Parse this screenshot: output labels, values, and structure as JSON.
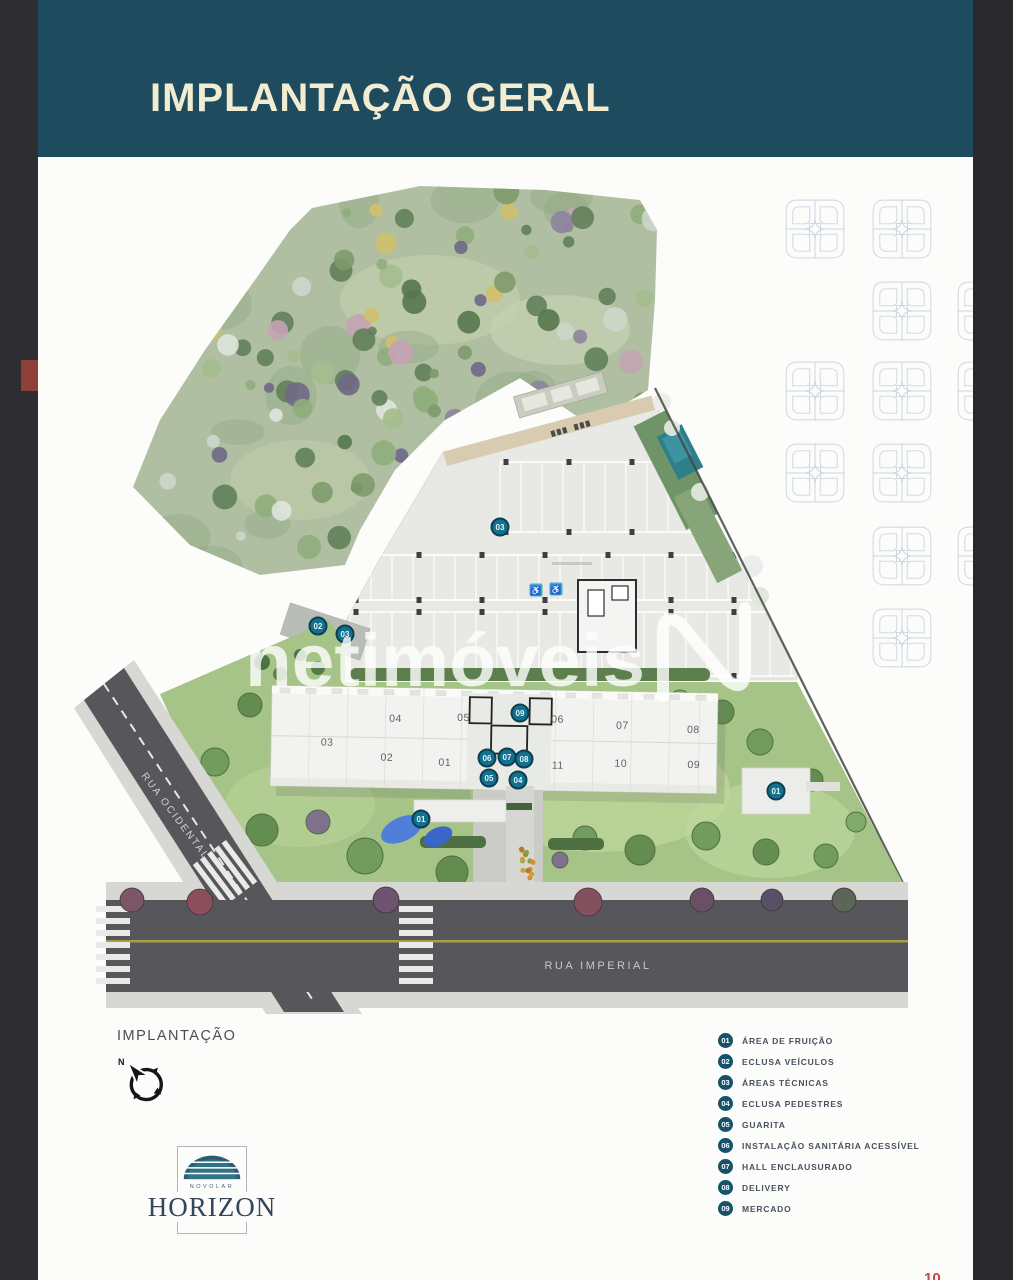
{
  "window": {
    "left_strip_color": "#2e2e32",
    "right_strip_color": "#29292d",
    "page_bg": "#fcfcfb"
  },
  "header": {
    "title": "IMPLANTAÇÃO GERAL",
    "bg_color": "#1e4c5e",
    "text_color": "#f2ecd2"
  },
  "watermark": {
    "text": "netimóveis",
    "logo": "netimoveis-n-outline"
  },
  "site_plan": {
    "streets": [
      {
        "name": "RUA OCIDENTAL"
      },
      {
        "name": "RUA IMPERIAL"
      }
    ],
    "tower_numbers": [
      {
        "label": "04",
        "x": 396,
        "y": 716
      },
      {
        "label": "05",
        "x": 464,
        "y": 714
      },
      {
        "label": "06",
        "x": 558,
        "y": 714
      },
      {
        "label": "07",
        "x": 623,
        "y": 719
      },
      {
        "label": "08",
        "x": 694,
        "y": 722
      },
      {
        "label": "03",
        "x": 328,
        "y": 741
      },
      {
        "label": "02",
        "x": 388,
        "y": 755
      },
      {
        "label": "01",
        "x": 446,
        "y": 759
      },
      {
        "label": "11",
        "x": 559,
        "y": 760
      },
      {
        "label": "10",
        "x": 622,
        "y": 757
      },
      {
        "label": "09",
        "x": 695,
        "y": 757
      }
    ],
    "markers": [
      {
        "label": "02",
        "x": 318,
        "y": 626
      },
      {
        "label": "03",
        "x": 345,
        "y": 634
      },
      {
        "label": "03",
        "x": 500,
        "y": 527
      },
      {
        "label": "09",
        "x": 520,
        "y": 713
      },
      {
        "label": "06",
        "x": 487,
        "y": 758
      },
      {
        "label": "07",
        "x": 507,
        "y": 757
      },
      {
        "label": "08",
        "x": 524,
        "y": 759
      },
      {
        "label": "05",
        "x": 489,
        "y": 778
      },
      {
        "label": "04",
        "x": 518,
        "y": 780
      },
      {
        "label": "01",
        "x": 421,
        "y": 819
      },
      {
        "label": "01",
        "x": 776,
        "y": 791
      }
    ],
    "accessible_parking_icon": "wheelchair-on-blue-square",
    "accessible_stalls": [
      {
        "x": 536,
        "y": 590
      },
      {
        "x": 556,
        "y": 589
      }
    ],
    "marker_color": "#12718f",
    "marker_ring_color": "#0d3e52"
  },
  "footer": {
    "section_label": "IMPLANTAÇÃO",
    "compass_icon": "north-arrow-compass",
    "logo": {
      "brand": "NOVOLAR",
      "name": "HORIZON"
    },
    "page_number": "10"
  },
  "legend": {
    "badge_color": "#16536a",
    "items": [
      {
        "num": "01",
        "label": "ÁREA DE FRUIÇÃO"
      },
      {
        "num": "02",
        "label": "ECLUSA VEÍCULOS"
      },
      {
        "num": "03",
        "label": "ÁREAS TÉCNICAS"
      },
      {
        "num": "04",
        "label": "ECLUSA PEDESTRES"
      },
      {
        "num": "05",
        "label": "GUARITA"
      },
      {
        "num": "06",
        "label": "INSTALAÇÃO SANITÁRIA ACESSÍVEL"
      },
      {
        "num": "07",
        "label": "HALL ENCLAUSURADO"
      },
      {
        "num": "08",
        "label": "DELIVERY"
      },
      {
        "num": "09",
        "label": "MERCADO"
      }
    ]
  },
  "decor": {
    "pattern_motif": "four-petal-flower-outline",
    "pattern_color": "#ccd6e1"
  }
}
